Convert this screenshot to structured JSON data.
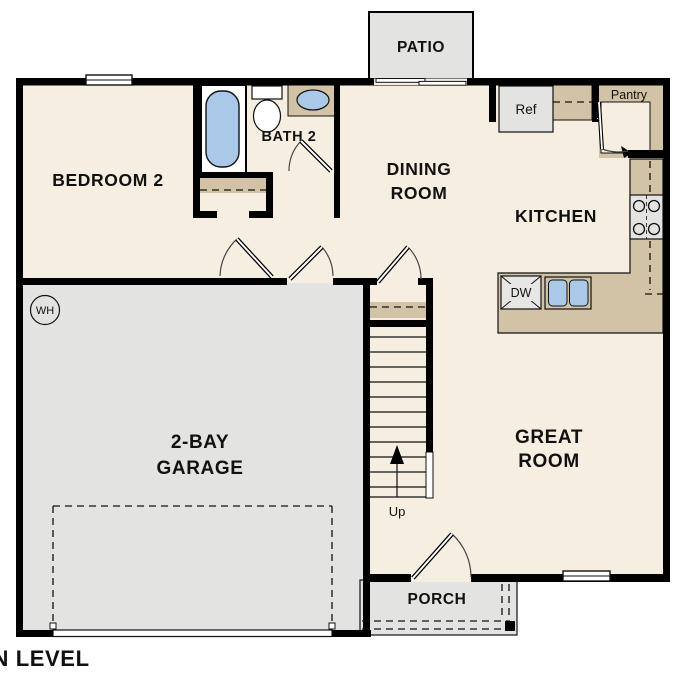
{
  "title": "MAIN LEVEL",
  "rooms": {
    "bedroom2": "BEDROOM 2",
    "bath2": "BATH 2",
    "dining_line1": "DINING",
    "dining_line2": "ROOM",
    "kitchen": "KITCHEN",
    "great_line1": "GREAT",
    "great_line2": "ROOM",
    "garage_line1": "2-BAY",
    "garage_line2": "GARAGE",
    "patio": "PATIO",
    "porch": "PORCH",
    "pantry": "Pantry"
  },
  "fixtures": {
    "refrigerator": "Ref",
    "dishwasher": "DW",
    "water_heater": "WH",
    "stairs_direction": "Up"
  },
  "colors": {
    "floor": "#f6eee0",
    "casework_tan": "#d2c3a6",
    "surface_gray": "#e3e3e1",
    "plumbing_blue": "#aac9e8",
    "walls": "#000000"
  }
}
